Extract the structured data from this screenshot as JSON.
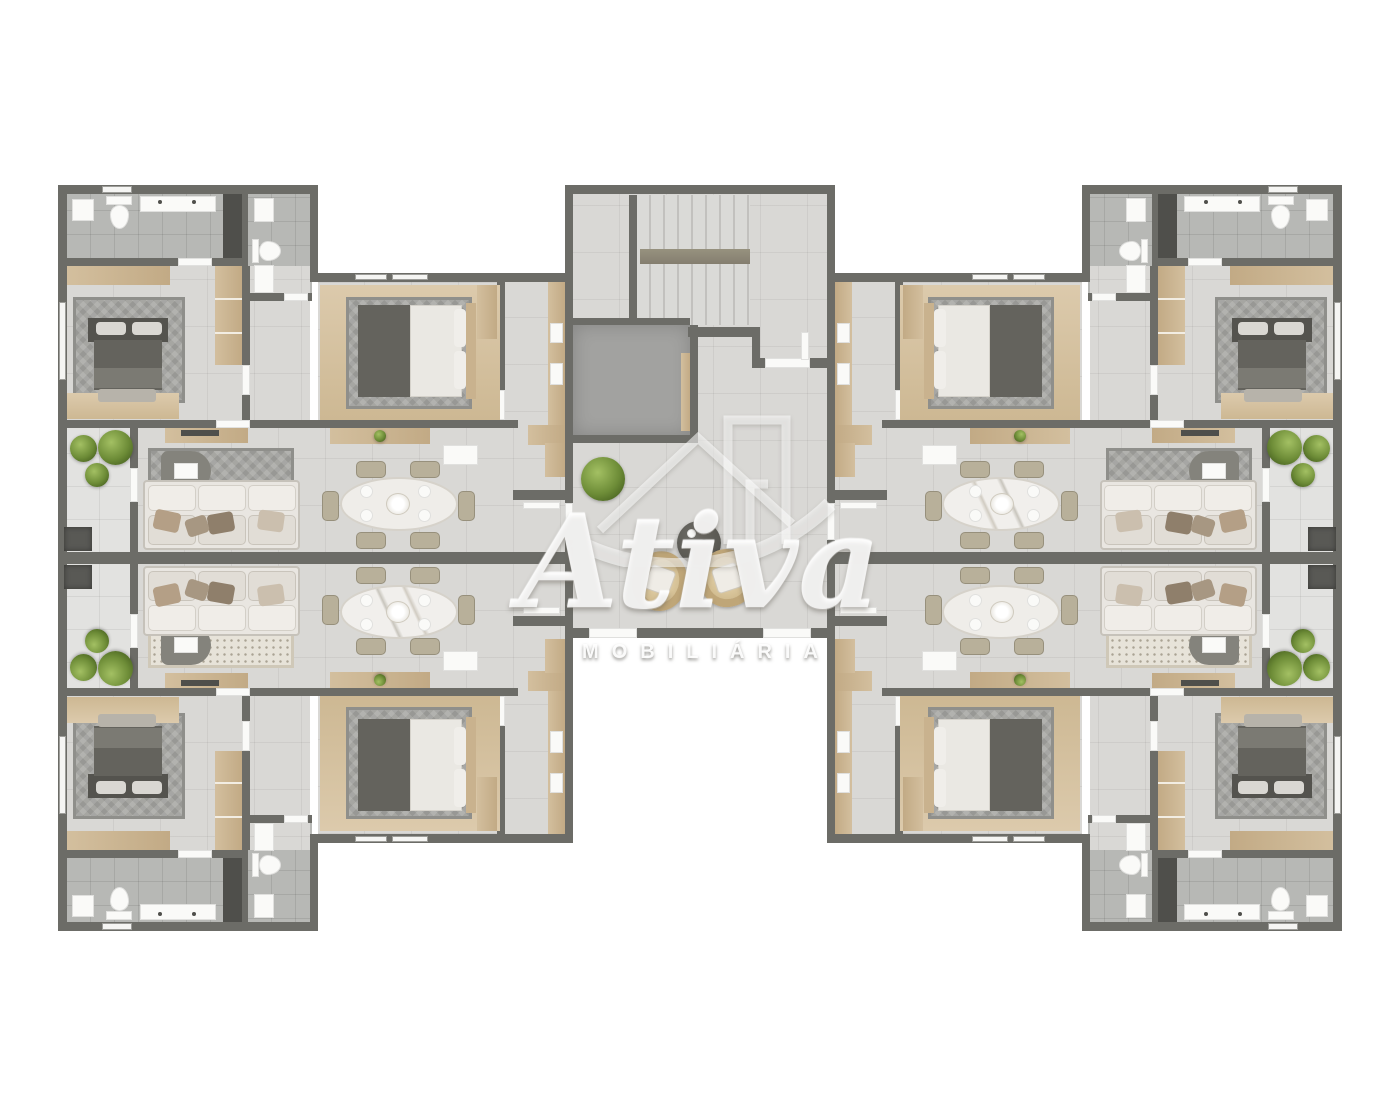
{
  "watermark": {
    "brand": "Ativa",
    "subtitle": "MOBILIÁRIA",
    "logo": "house-roof-and-tower-emblem-with-swoosh"
  },
  "palette": {
    "background": "#ffffff",
    "walls": "#6c6c67",
    "floor_tile": "#d9d8d5",
    "bathroom_floor": "#b7b8b5",
    "balcony_floor": "#e2e2e0",
    "wood_cabinetry": "#cdb795",
    "dark_bed": "#64635d",
    "gray_rug": "#a6a6a2",
    "speckled_rug": "#e7e3d9",
    "sofa": "#e9e6e1",
    "plant_green": "#6d8c37",
    "planter": "#595955",
    "elevator_shaft": "#a2a2a0",
    "stair_tread": "#dadad7",
    "wicker_chair": "#bfa678",
    "round_table": "#55544e"
  },
  "floor_plan": {
    "type": "residential apartment building floor plan, top-down 3D render",
    "apartments": 4,
    "layout": "two mirrored wings (left and right) joined by a central core; white page background",
    "apartment_rooms": [
      "corner bedroom with dark double bed, patterned rug, headboard shelf and tall wardrobe",
      "en-suite bathroom with washer, toilet, double vanity and dark shower strip",
      "second bathroom with sink, toilet and vanity",
      "inner bedroom with bed on wood floor border and wardrobe",
      "kitchen run along the hall wall with counter, sink, cooktop and island",
      "dining area with table, chairs and centerpiece",
      "living area with large cushioned sofa, rug, dark chaise and TV sideboard",
      "balcony with three shrubs and a dark planter"
    ],
    "central_core": [
      "double-flight staircase with mid landing",
      "elevator shaft / void",
      "entry hall with two wicker armchairs, round side table and potted plant",
      "apartment entry doors on both side walls and two door openings on the lower wall"
    ]
  }
}
